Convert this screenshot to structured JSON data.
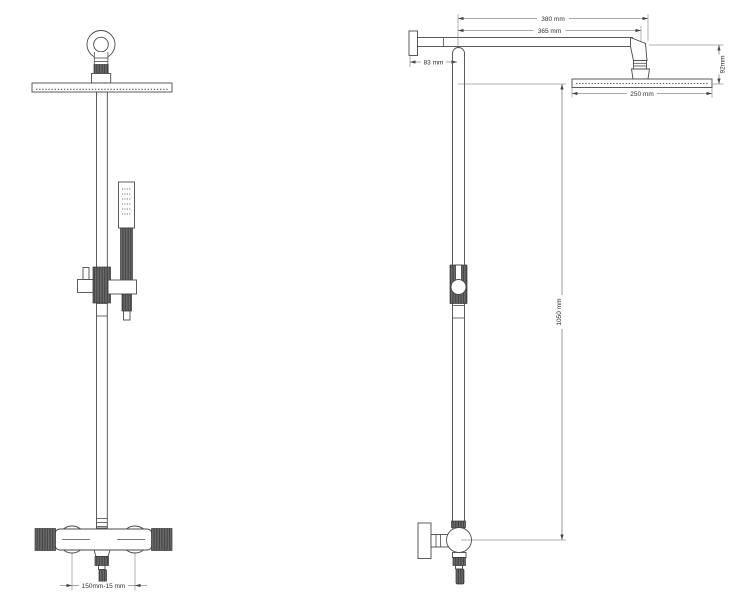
{
  "drawing": {
    "description": "Technical dimension drawing of a thermostatic shower column, front view and side view",
    "views": [
      "front-view",
      "side-view"
    ]
  },
  "dimensions": {
    "arm_length_total": "380 mm",
    "arm_length_to_head_center": "365 mm",
    "wall_to_riser": "83 mm",
    "head_assembly_height": "92mm",
    "head_diameter": "250 mm",
    "riser_height": "1050 mm",
    "valve_inlet_spacing": "150mm-15 mm"
  },
  "colors": {
    "line": "#4a4a4a",
    "dim_line": "#555555",
    "dark_fill": "#6a6a6a",
    "background": "#ffffff"
  }
}
